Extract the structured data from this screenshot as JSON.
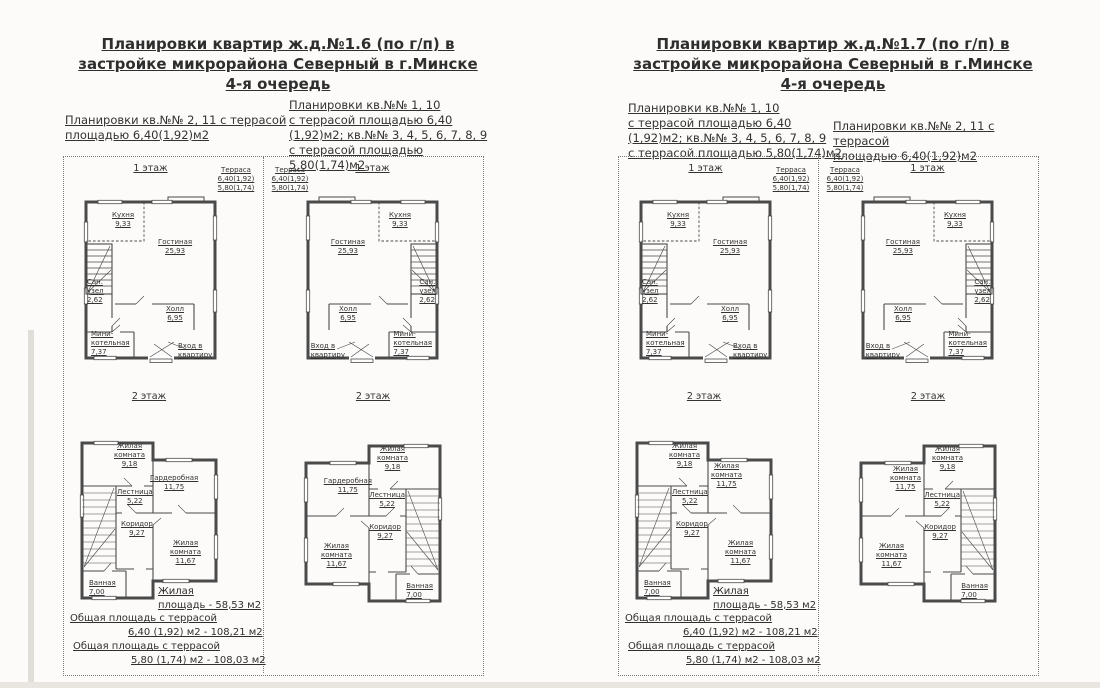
{
  "pages": [
    {
      "title": [
        "Планировки квартир ж.д.№1.6  (по г/п) в",
        "застройке микрорайона Северный в г.Минске",
        "4-я очередь"
      ],
      "note_left": [
        "Планировки кв.№№ 2, 11 с террасой",
        "площадью 6,40(1,92)м2"
      ],
      "note_right": [
        "Планировки кв.№№ 1, 10",
        "с террасой площадью 6,40",
        "(1,92)м2; кв.№№ 3, 4, 5, 6, 7, 8, 9",
        "с террасой площадью 5,80(1,74)м2"
      ]
    },
    {
      "title": [
        "Планировки квартир ж.д.№1.7  (по г/п) в",
        "застройке микрорайона Северный в г.Минске",
        "4-я очередь"
      ],
      "note_left": [
        "Планировки кв.№№ 1, 10",
        "с террасой площадью 6,40",
        "(1,92)м2; кв.№№ 3, 4, 5, 6, 7, 8, 9",
        "с террасой площадью 5,80(1,74)м2"
      ],
      "note_right": [
        "Планировки кв.№№ 2, 11 с террасой",
        "площадью 6,40(1,92)м2"
      ]
    }
  ],
  "floors": {
    "f1": "1 этаж",
    "f2": "2 этаж"
  },
  "terrace": {
    "name": "Терраса",
    "v1": "6,40(1,92)",
    "v2": "5,80(1,74)"
  },
  "rooms_f1": {
    "kitchen": {
      "name": "Кухня",
      "area": "9,33"
    },
    "living": {
      "name": "Гостиная",
      "area": "25,93"
    },
    "wc": {
      "l1": "Сан.",
      "l2": "узел",
      "area": "2,62"
    },
    "hall": {
      "name": "Холл",
      "area": "6,95"
    },
    "boiler": {
      "l1": "Мини-",
      "l2": "котельная",
      "area": "7,37"
    },
    "entry": {
      "l1": "Вход в",
      "l2": "квартиру"
    }
  },
  "rooms_f2": {
    "bedroom_small": {
      "l1": "Жилая",
      "l2": "комната",
      "area": "9,18"
    },
    "wardrobe": {
      "name": "Гардеробная",
      "area": "11,75"
    },
    "bedroom_mid": {
      "l1": "Жилая",
      "l2": "комната",
      "area": "11,75"
    },
    "stairs": {
      "name": "Лестница",
      "area": "5,22"
    },
    "corridor": {
      "name": "Коридор",
      "area": "9,27"
    },
    "bedroom_large": {
      "l1": "Жилая",
      "l2": "комната",
      "area": "11,67"
    },
    "bath": {
      "name": "Ванная",
      "area": "7,00"
    }
  },
  "summary": {
    "living_l1": "Жилая",
    "living_l2": "площадь - 58,53 м2",
    "total_label1": "Общая площадь с террасой",
    "total_value1": "6,40 (1,92) м2 - 108,21 м2",
    "total_label2": "Общая площадь с террасой",
    "total_value2": "5,80 (1,74) м2 - 108,03 м2"
  },
  "colors": {
    "ink": "#3a3a3a",
    "wall": "#4a4a4a",
    "border": "#787878"
  }
}
